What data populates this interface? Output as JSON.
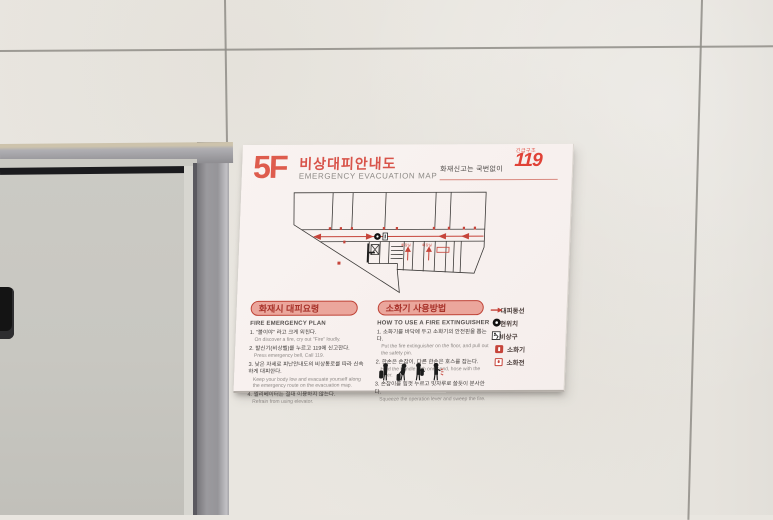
{
  "colors": {
    "sign_red": "#d8544a",
    "pill_fill": "#eba69c",
    "pill_border": "#bf4337",
    "route_red": "#c6443a",
    "wall": "#e9e6e0",
    "door_panel": "#c8c7c1",
    "door_frame": "#969599"
  },
  "sign": {
    "floor": "5F",
    "title_ko": "비상대피안내도",
    "title_en": "EMERGENCY EVACUATION MAP",
    "report_text": "화재신고는 국번없이",
    "logo": {
      "small": "긴급구조",
      "number": "119"
    },
    "map_labels": {
      "restroom1": "화장실",
      "restroom2": "화장실"
    },
    "sections": {
      "evacuation": {
        "header": "화재시 대피요령",
        "subheader": "FIRE EMERGENCY PLAN",
        "items": [
          {
            "ko": "1. \"불이야\" 라고 크게 외친다.",
            "en": "On discover a fire, cry out \"Fire\" loudly."
          },
          {
            "ko": "2. 발신기(비상벨)를 누르고 119에 신고한다.",
            "en": "Press emergency bell, Call 119."
          },
          {
            "ko": "3. 낮은 자세로 피난안내도의 비상통로를 따라 신속하게 대피한다.",
            "en": "Keep your body low and evacuate yourself along the emergency route on the evacuation map."
          },
          {
            "ko": "4. 엘리베이터는 절대 이용하지 않는다.",
            "en": "Refrain from using elevator."
          }
        ]
      },
      "extinguisher": {
        "header": "소화기 사용방법",
        "subheader": "HOW TO USE A FIRE EXTINGUISHER",
        "items": [
          {
            "ko": "1. 소화기를 바닥에 두고 소화기의 안전핀을 뽑는다.",
            "en": "Put the fire extinguisher on the floor, and pull out the safety pin."
          },
          {
            "ko": "2. 한손은 손잡이, 다른 한손은 호스를 잡는다.",
            "en": "Hold the handle with one hand, hose with the other."
          },
          {
            "ko": "3. 손잡이를 힘껏 누르고 빗자루로 쓸듯이 분사한다.",
            "en": "Squeeze the operation lever and sweep the fire."
          }
        ]
      }
    },
    "legend": {
      "items": [
        {
          "icon": "route-arrow-icon",
          "label": "대피동선"
        },
        {
          "icon": "current-location-icon",
          "label": "현위치"
        },
        {
          "icon": "emergency-exit-icon",
          "label": "비상구"
        },
        {
          "icon": "fire-extinguisher-icon",
          "label": "소화기"
        },
        {
          "icon": "fire-hydrant-icon",
          "label": "소화전"
        }
      ]
    }
  }
}
